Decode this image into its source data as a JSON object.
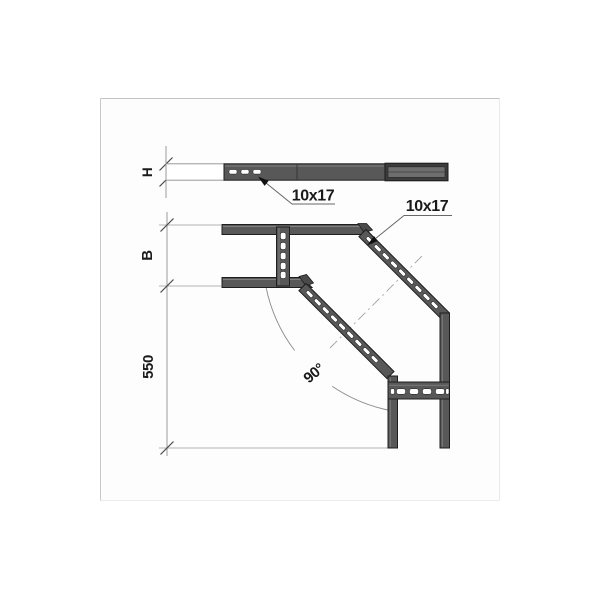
{
  "drawing": {
    "labels": {
      "height_dim": "H",
      "width_dim": "B",
      "length_dim": "550",
      "angle_dim": "90°",
      "slot_callout_side": "10x17",
      "slot_callout_plan": "10x17"
    },
    "colors": {
      "rail_fill": "#585858",
      "rail_outline": "#1e1e1e",
      "connector_inner": "#6e6e6e",
      "slot_fill": "#ffffff",
      "dimension_line": "#8f8f8f",
      "leader_line": "#676767",
      "text": "#1a1a1a",
      "frame_border": "#c6c6c6",
      "background": "#ffffff"
    }
  }
}
